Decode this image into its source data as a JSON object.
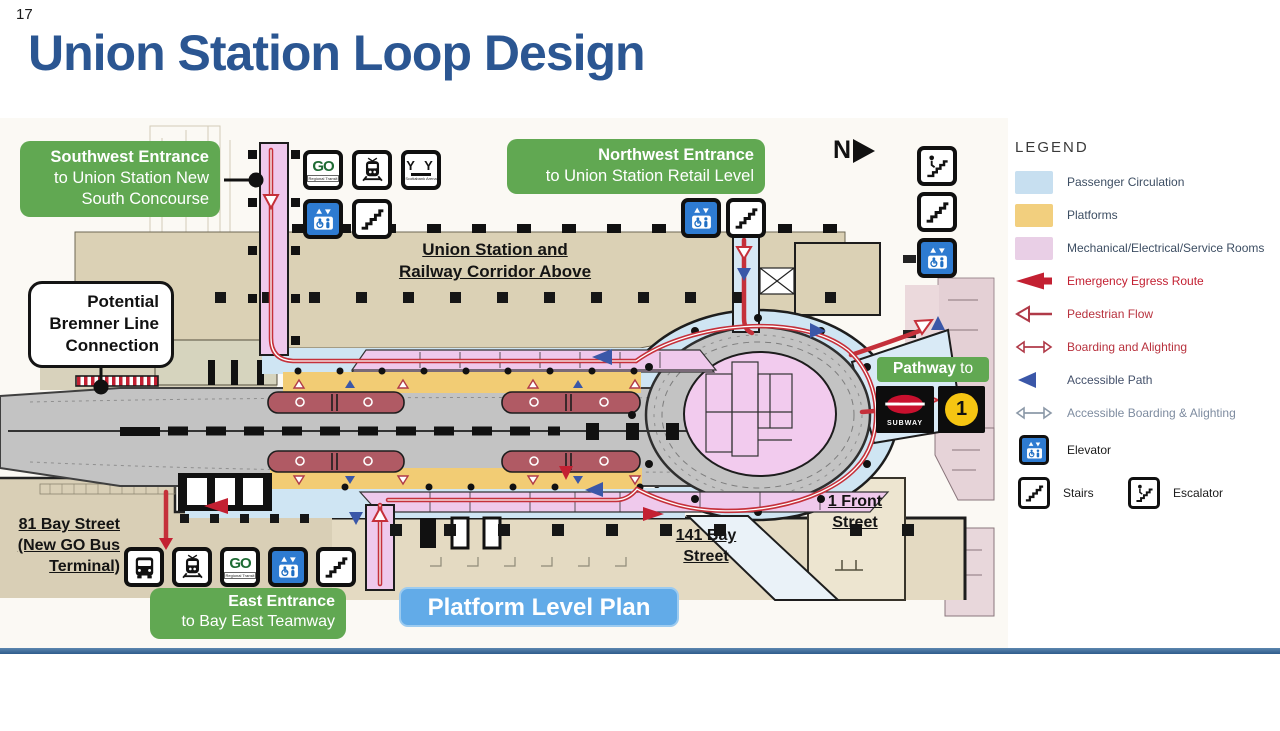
{
  "page": {
    "number": "17",
    "title": "Union Station Loop Design"
  },
  "callouts": {
    "southwest": {
      "title": "Southwest Entrance",
      "line2": "to Union Station New",
      "line3": "South Concourse"
    },
    "northwest": {
      "title": "Northwest Entrance",
      "line2": "to Union Station Retail Level"
    },
    "east": {
      "title": "East Entrance",
      "line2": "to Bay East Teamway"
    },
    "bremner": {
      "line1": "Potential",
      "line2": "Bremner Line",
      "line3": "Connection"
    },
    "pathway": {
      "bold": "Pathway",
      "rest": " to"
    }
  },
  "labels": {
    "corridor_line1": "Union Station and",
    "corridor_line2": "Railway Corridor Above",
    "bay81_line1": "81 Bay Street",
    "bay81_line2": "(New GO Bus",
    "bay81_line3": "Terminal)",
    "bay141_line1": "141 Bay",
    "bay141_line2": "Street",
    "front1_line1": "1 Front",
    "front1_line2": "Street",
    "plan_title": "Platform Level Plan",
    "north": "N"
  },
  "badges": {
    "go_text": "GO",
    "go_sub": "Regional Transit",
    "arena_text": "Y Y",
    "arena_sub": "Scotiabank Arena",
    "subway_text": "SUBWAY",
    "line1": "1"
  },
  "legend": {
    "title": "LEGEND",
    "items": [
      {
        "label": "Passenger Circulation",
        "type": "swatch",
        "color": "#c7dff0"
      },
      {
        "label": "Platforms",
        "type": "swatch",
        "color": "#f2cf7e"
      },
      {
        "label": "Mechanical/Electrical/Service Rooms",
        "type": "swatch",
        "color": "#e9cfe6"
      },
      {
        "label": "Emergency Egress Route",
        "type": "solid-red-arrow",
        "color": "#c32032"
      },
      {
        "label": "Pedestrian Flow",
        "type": "outline-red-arrow",
        "color": "#b03a48"
      },
      {
        "label": "Boarding and Alighting",
        "type": "double-red-arrow",
        "color": "#b03a48"
      },
      {
        "label": "Accessible Path",
        "type": "solid-blue-triangle",
        "color": "#3a57a8"
      },
      {
        "label": "Accessible Boarding & Alighting",
        "type": "double-gray-arrow",
        "color": "#8c99a8"
      },
      {
        "label": "Elevator",
        "type": "elevator-icon"
      },
      {
        "label": "Stairs",
        "type": "stairs-icon"
      },
      {
        "label": "Escalator",
        "type": "escalator-icon"
      }
    ]
  },
  "colors": {
    "title_blue": "#2b5692",
    "callout_green": "#61a852",
    "plan_blue": "#62abe8",
    "passenger_circulation": "#cfe5f3",
    "platform_yellow": "#f2cc74",
    "service_pink": "#efc9ec",
    "egress_red": "#c32032",
    "flow_red": "#c5303a",
    "accessible_blue": "#3a57a8",
    "track_gray": "#c3c3c3",
    "building_tan": "#dbd1b5",
    "subway_red": "#c8102e",
    "line1_yellow": "#f6c512"
  }
}
